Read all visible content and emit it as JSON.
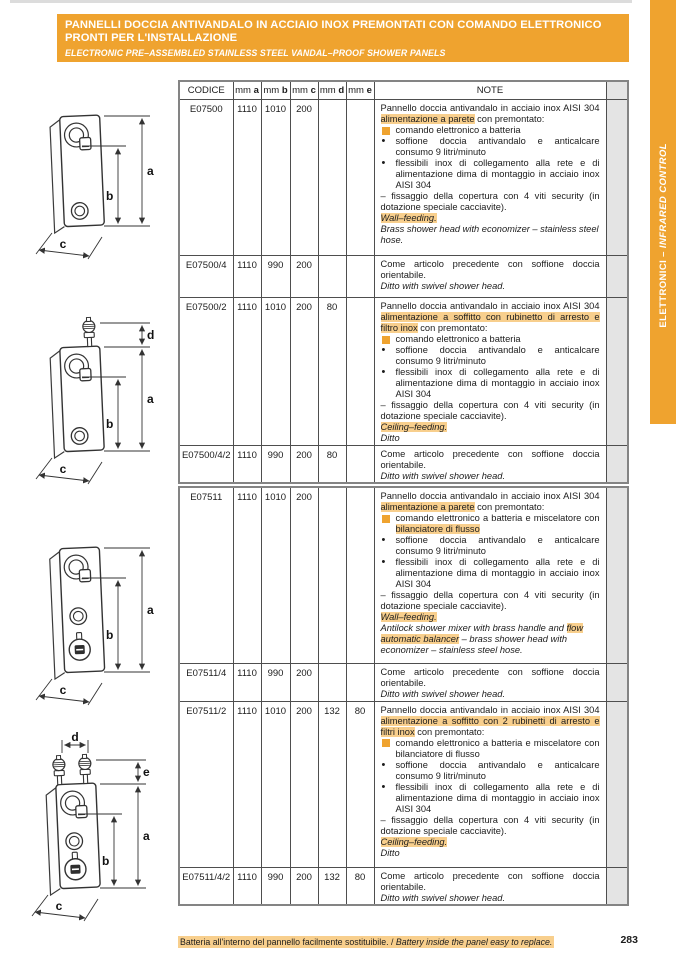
{
  "colors": {
    "accent_orange": "#EFA32F",
    "highlight_orange": "#F8CF8D",
    "filler_gray": "#e4e4e4"
  },
  "header": {
    "title_line1": "PANNELLI DOCCIA ANTIVANDALO IN ACCIAIO INOX PREMONTATI CON COMANDO ELETTRONICO",
    "title_line2": "PRONTI PER L'INSTALLAZIONE",
    "subtitle": "ELECTRONIC PRE–ASSEMBLED STAINLESS STEEL VANDAL–PROOF SHOWER PANELS"
  },
  "sidebar_tab": {
    "text_main": "ELETTRONICI – ",
    "text_italic": "INFRARED CONTROL"
  },
  "columns": [
    {
      "t": "CODICE"
    },
    {
      "t": "mm ",
      "b": "a"
    },
    {
      "t": "mm ",
      "b": "b"
    },
    {
      "t": "mm ",
      "b": "c"
    },
    {
      "t": "mm ",
      "b": "d"
    },
    {
      "t": "mm ",
      "b": "e"
    },
    {
      "t": "NOTE"
    },
    {
      "t": ""
    }
  ],
  "tables": [
    {
      "name": "series-E07500",
      "rows": [
        {
          "code": "E07500",
          "a": "1110",
          "b": "1010",
          "c": "200",
          "d": "",
          "e": "",
          "note": [
            {
              "k": "p",
              "seg": [
                {
                  "t": "Pannello doccia antivandalo in acciaio inox AISI 304 "
                },
                {
                  "t": "alimentazione a parete",
                  "hl": true
                },
                {
                  "t": " con premontato:"
                }
              ]
            },
            {
              "k": "sq",
              "seg": [
                {
                  "t": "comando elettronico a batteria"
                }
              ]
            },
            {
              "k": "dot",
              "seg": [
                {
                  "t": "soffione doccia antivandalo e anticalcare consumo 9 litri/minuto"
                }
              ]
            },
            {
              "k": "dot",
              "seg": [
                {
                  "t": "flessibili inox di collegamento alla rete e di alimentazione dima di montaggio in acciaio inox AISI 304"
                }
              ]
            },
            {
              "k": "dash",
              "seg": [
                {
                  "t": "– fissaggio della copertura con 4 viti security (in dotazione speciale cacciavite)."
                }
              ]
            },
            {
              "k": "it",
              "seg": [
                {
                  "t": "Wall–feeding.",
                  "hl": true
                }
              ]
            },
            {
              "k": "it",
              "seg": [
                {
                  "t": "Brass shower head with economizer – stainless steel hose."
                }
              ]
            }
          ]
        },
        {
          "code": "E07500/4",
          "a": "1110",
          "b": "990",
          "c": "200",
          "d": "",
          "e": "",
          "note": [
            {
              "k": "p",
              "seg": [
                {
                  "t": "Come articolo precedente con soffione doccia orientabile."
                }
              ]
            },
            {
              "k": "it",
              "seg": [
                {
                  "t": "Ditto with swivel shower head."
                }
              ]
            }
          ]
        },
        {
          "code": "E07500/2",
          "a": "1110",
          "b": "1010",
          "c": "200",
          "d": "80",
          "e": "",
          "note": [
            {
              "k": "p",
              "seg": [
                {
                  "t": "Pannello doccia antivandalo in acciaio inox AISI 304 "
                },
                {
                  "t": "alimentazione a soffitto con rubinetto di arresto e filtro inox",
                  "hl": true
                },
                {
                  "t": " con premontato:"
                }
              ]
            },
            {
              "k": "sq",
              "seg": [
                {
                  "t": "comando elettronico a batteria"
                }
              ]
            },
            {
              "k": "dot",
              "seg": [
                {
                  "t": "soffione doccia antivandalo e anticalcare consumo 9 litri/minuto"
                }
              ]
            },
            {
              "k": "dot",
              "seg": [
                {
                  "t": "flessibili inox di collegamento alla rete e di alimentazione dima di montaggio in acciaio inox AISI 304"
                }
              ]
            },
            {
              "k": "dash",
              "seg": [
                {
                  "t": "– fissaggio della copertura con 4 viti security (in dotazione speciale cacciavite)."
                }
              ]
            },
            {
              "k": "it",
              "seg": [
                {
                  "t": "Ceiling–feeding.",
                  "hl": true
                }
              ]
            },
            {
              "k": "it",
              "seg": [
                {
                  "t": "Ditto"
                }
              ]
            }
          ]
        },
        {
          "code": "E07500/4/2",
          "a": "1110",
          "b": "990",
          "c": "200",
          "d": "80",
          "e": "",
          "note": [
            {
              "k": "p",
              "seg": [
                {
                  "t": "Come articolo precedente con soffione doccia orientabile."
                }
              ]
            },
            {
              "k": "it",
              "seg": [
                {
                  "t": "Ditto with swivel shower head."
                }
              ]
            }
          ]
        }
      ]
    },
    {
      "name": "series-E07511",
      "rows": [
        {
          "code": "E07511",
          "a": "1110",
          "b": "1010",
          "c": "200",
          "d": "",
          "e": "",
          "note": [
            {
              "k": "p",
              "seg": [
                {
                  "t": "Pannello doccia antivandalo in acciaio inox AISI 304 "
                },
                {
                  "t": "alimentazione a parete",
                  "hl": true
                },
                {
                  "t": " con premontato:"
                }
              ]
            },
            {
              "k": "sq",
              "seg": [
                {
                  "t": "comando elettronico a batteria e miscelatore con "
                },
                {
                  "t": "bilanciatore di flusso",
                  "hl": true
                }
              ]
            },
            {
              "k": "dot",
              "seg": [
                {
                  "t": "soffione doccia antivandalo e anticalcare consumo 9 litri/minuto"
                }
              ]
            },
            {
              "k": "dot",
              "seg": [
                {
                  "t": "flessibili inox di collegamento alla rete e di alimentazione dima di montaggio in acciaio inox AISI 304"
                }
              ]
            },
            {
              "k": "dash",
              "seg": [
                {
                  "t": "– fissaggio della copertura con 4 viti security (in dotazione speciale cacciavite)."
                }
              ]
            },
            {
              "k": "it",
              "seg": [
                {
                  "t": "Wall–feeding.",
                  "hl": true
                }
              ]
            },
            {
              "k": "it",
              "seg": [
                {
                  "t": "Antilock shower mixer with brass handle and "
                },
                {
                  "t": "flow automatic balancer",
                  "hl": true
                },
                {
                  "t": " – brass shower head with economizer – stainless steel hose."
                }
              ]
            }
          ]
        },
        {
          "code": "E07511/4",
          "a": "1110",
          "b": "990",
          "c": "200",
          "d": "",
          "e": "",
          "note": [
            {
              "k": "p",
              "seg": [
                {
                  "t": "Come articolo precedente con soffione doccia orientabile."
                }
              ]
            },
            {
              "k": "it",
              "seg": [
                {
                  "t": "Ditto with swivel shower head."
                }
              ]
            }
          ]
        },
        {
          "code": "E07511/2",
          "a": "1110",
          "b": "1010",
          "c": "200",
          "d": "132",
          "e": "80",
          "note": [
            {
              "k": "p",
              "seg": [
                {
                  "t": "Pannello doccia antivandalo in acciaio inox AISI 304 "
                },
                {
                  "t": "alimentazione a soffitto con 2 rubinetti di arresto e filtri inox",
                  "hl": true
                },
                {
                  "t": " con premontato:"
                }
              ]
            },
            {
              "k": "sq",
              "seg": [
                {
                  "t": "comando elettronico a batteria e miscelatore con bilanciatore di flusso"
                }
              ]
            },
            {
              "k": "dot",
              "seg": [
                {
                  "t": "soffione doccia antivandalo e anticalcare consumo 9 litri/minuto"
                }
              ]
            },
            {
              "k": "dot",
              "seg": [
                {
                  "t": "flessibili inox di collegamento alla rete e di alimentazione dima di montaggio in acciaio inox AISI 304"
                }
              ]
            },
            {
              "k": "dash",
              "seg": [
                {
                  "t": "– fissaggio della copertura con 4 viti security (in dotazione speciale cacciavite)."
                }
              ]
            },
            {
              "k": "it",
              "seg": [
                {
                  "t": "Ceiling–feeding.",
                  "hl": true
                }
              ]
            },
            {
              "k": "it",
              "seg": [
                {
                  "t": "Ditto"
                }
              ]
            }
          ]
        },
        {
          "code": "E07511/4/2",
          "a": "1110",
          "b": "990",
          "c": "200",
          "d": "132",
          "e": "80",
          "note": [
            {
              "k": "p",
              "seg": [
                {
                  "t": "Come articolo precedente con soffione doccia orientabile."
                }
              ]
            },
            {
              "k": "it",
              "seg": [
                {
                  "t": "Ditto with swivel shower head."
                }
              ]
            }
          ]
        }
      ]
    }
  ],
  "drawings": [
    {
      "name": "panel-wall-feeding",
      "dims": {
        "a": "a",
        "b": "b",
        "c": "c"
      }
    },
    {
      "name": "panel-ceiling-feeding",
      "dims": {
        "a": "a",
        "b": "b",
        "c": "c",
        "d": "d"
      }
    },
    {
      "name": "panel-wall-feeding-mixer",
      "dims": {
        "a": "a",
        "b": "b",
        "c": "c"
      }
    },
    {
      "name": "panel-ceiling-feeding-mixer",
      "dims": {
        "a": "a",
        "b": "b",
        "c": "c",
        "d": "d",
        "e": "e"
      }
    }
  ],
  "footer": {
    "note_it": "Batteria all'interno del pannello facilmente sostituibile. / ",
    "note_en": "Battery inside the panel easy to replace.",
    "page_number": "283"
  }
}
